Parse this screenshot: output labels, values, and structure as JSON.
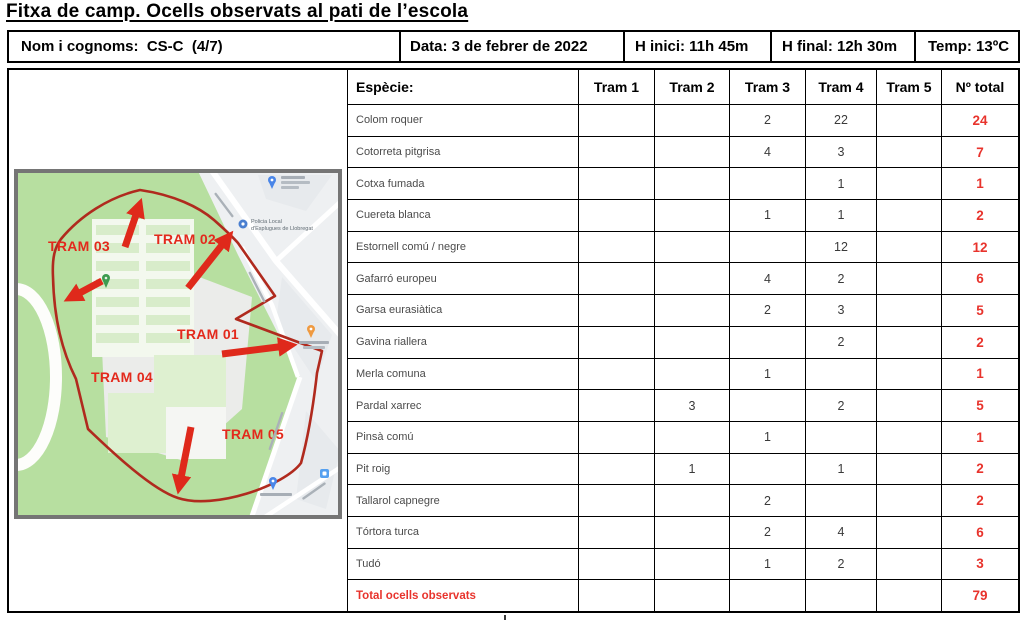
{
  "page": {
    "title": "Fitxa de camp. Ocells observats al pati de l’escola"
  },
  "info_bar": {
    "name": "Nom i cognoms:  CS-C  (4/7)",
    "date": "Data: 3 de febrer de 2022",
    "start": "H inici: 11h 45m",
    "end": "H final: 12h 30m",
    "temp": "Temp: 13ºC"
  },
  "table": {
    "headers": {
      "species": "Espècie:",
      "trams": [
        "Tram 1",
        "Tram 2",
        "Tram 3",
        "Tram 4",
        "Tram 5"
      ],
      "total": "Nº total"
    },
    "rows": [
      {
        "species": "Colom roquer",
        "values": [
          "",
          "",
          "2",
          "22",
          ""
        ],
        "total": "24"
      },
      {
        "species": "Cotorreta pitgrisa",
        "values": [
          "",
          "",
          "4",
          "3",
          ""
        ],
        "total": "7"
      },
      {
        "species": "Cotxa fumada",
        "values": [
          "",
          "",
          "",
          "1",
          ""
        ],
        "total": "1"
      },
      {
        "species": "Cuereta blanca",
        "values": [
          "",
          "",
          "1",
          "1",
          ""
        ],
        "total": "2"
      },
      {
        "species": "Estornell comú / negre",
        "values": [
          "",
          "",
          "",
          "12",
          ""
        ],
        "total": "12"
      },
      {
        "species": "Gafarró europeu",
        "values": [
          "",
          "",
          "4",
          "2",
          ""
        ],
        "total": "6"
      },
      {
        "species": "Garsa eurasiàtica",
        "values": [
          "",
          "",
          "2",
          "3",
          ""
        ],
        "total": "5"
      },
      {
        "species": "Gavina riallera",
        "values": [
          "",
          "",
          "",
          "2",
          ""
        ],
        "total": "2"
      },
      {
        "species": "Merla comuna",
        "values": [
          "",
          "",
          "1",
          "",
          ""
        ],
        "total": "1"
      },
      {
        "species": "Pardal xarrec",
        "values": [
          "",
          "3",
          "",
          "2",
          ""
        ],
        "total": "5"
      },
      {
        "species": "Pinsà comú",
        "values": [
          "",
          "",
          "1",
          "",
          ""
        ],
        "total": "1"
      },
      {
        "species": "Pit roig",
        "values": [
          "",
          "1",
          "",
          "1",
          ""
        ],
        "total": "2"
      },
      {
        "species": "Tallarol capnegre",
        "values": [
          "",
          "",
          "2",
          "",
          ""
        ],
        "total": "2"
      },
      {
        "species": "Tórtora turca",
        "values": [
          "",
          "",
          "2",
          "4",
          ""
        ],
        "total": "6"
      },
      {
        "species": "Tudó",
        "values": [
          "",
          "",
          "1",
          "2",
          ""
        ],
        "total": "3"
      }
    ],
    "total_row": {
      "label": "Total ocells observats",
      "total": "79"
    }
  },
  "map": {
    "tram_labels": {
      "t1": "TRAM 01",
      "t2": "TRAM 02",
      "t3": "TRAM 03",
      "t4": "TRAM 04",
      "t5": "TRAM 05"
    },
    "poi": {
      "policia_line1": "Policia Local",
      "policia_line2": "d'Esplugues de Llobregat"
    },
    "colors": {
      "accent_red": "#e8332c",
      "route_red": "#b02a1e",
      "arrow_red": "#df291b",
      "park_green": "#b7dfa0"
    }
  }
}
